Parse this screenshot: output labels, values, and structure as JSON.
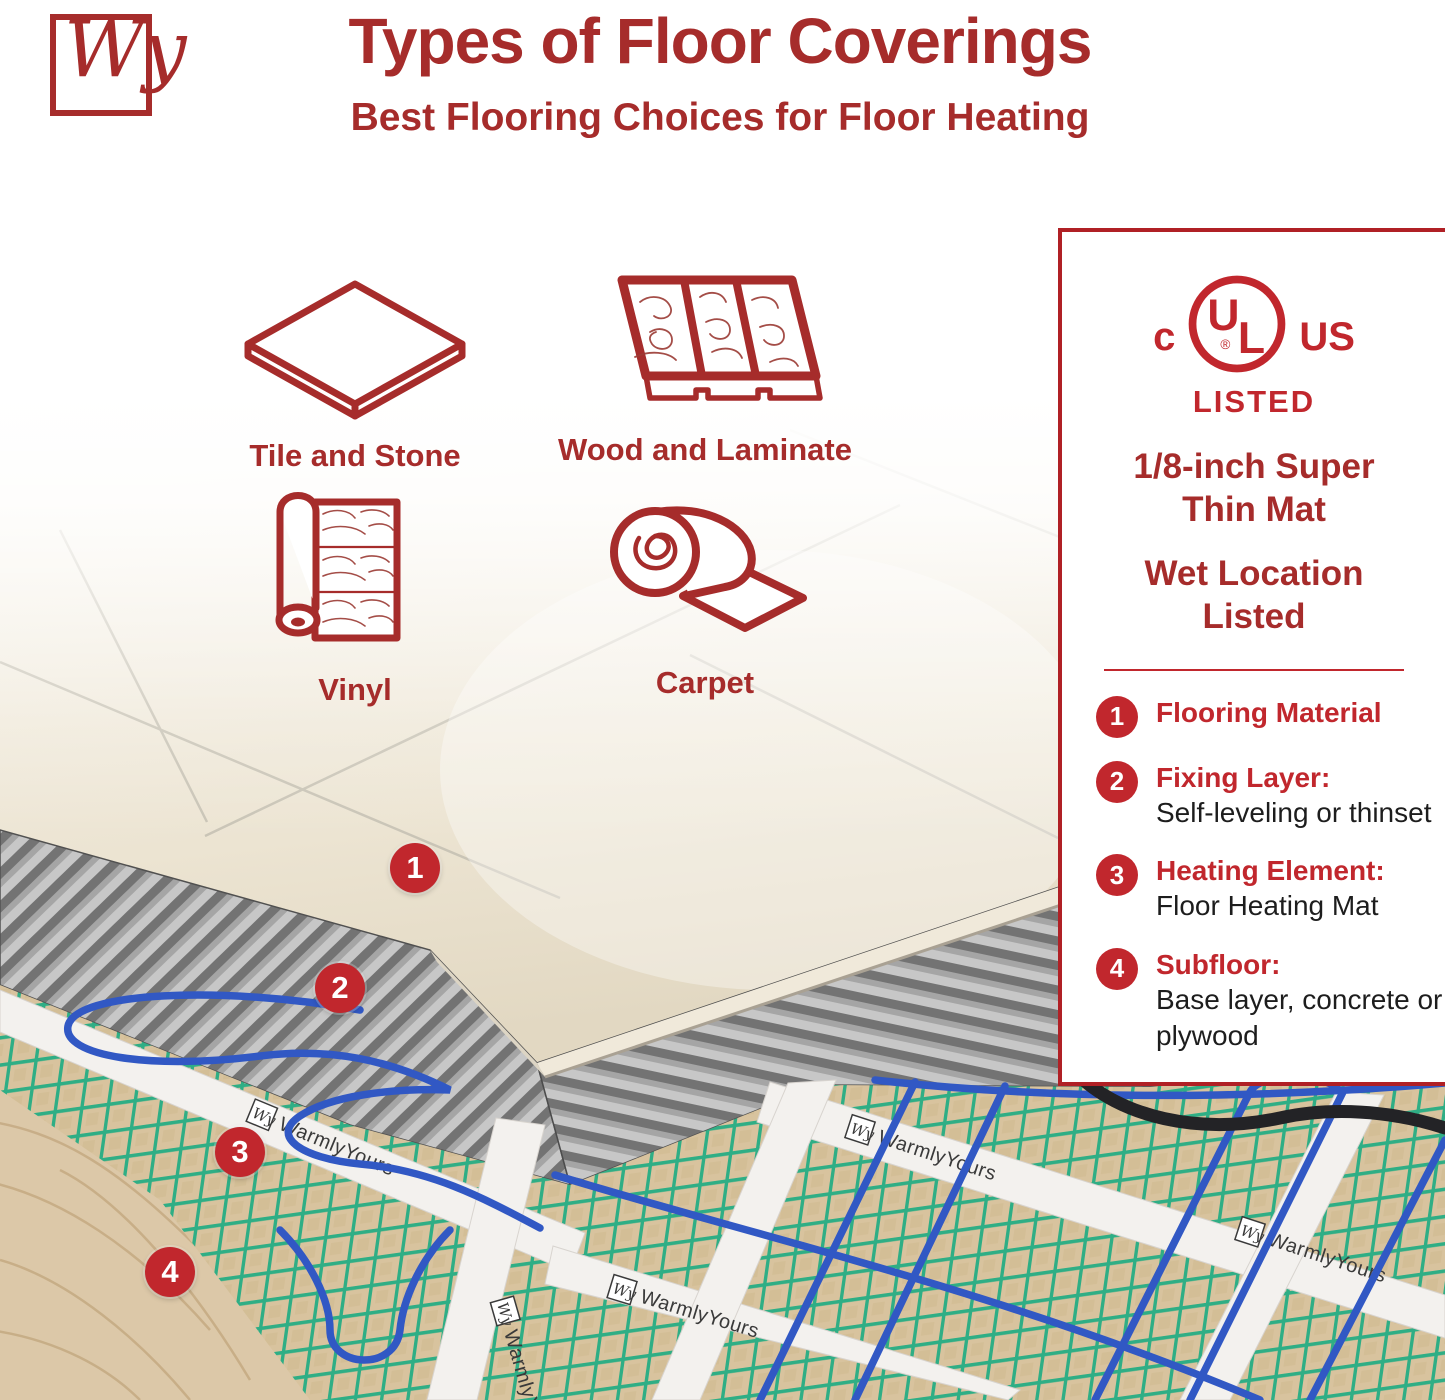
{
  "brand_logo": {
    "text": "Wy"
  },
  "header": {
    "title": "Types of Floor Coverings",
    "subtitle": "Best Flooring Choices for Floor Heating"
  },
  "floor_types": [
    {
      "label": "Tile and Stone"
    },
    {
      "label": "Wood and Laminate"
    },
    {
      "label": "Vinyl"
    },
    {
      "label": "Carpet"
    }
  ],
  "panel": {
    "ul_mark": {
      "prefix": "c",
      "letter_u": "U",
      "letter_l": "L",
      "registered": "®",
      "suffix": "US",
      "listed": "LISTED"
    },
    "features": [
      "1/8-inch Super Thin Mat",
      "Wet Location Listed"
    ],
    "legend": [
      {
        "num": "1",
        "title": "Flooring Material",
        "desc": ""
      },
      {
        "num": "2",
        "title": "Fixing Layer:",
        "desc": "Self-leveling or thinset"
      },
      {
        "num": "3",
        "title": "Heating Element:",
        "desc": "Floor Heating Mat"
      },
      {
        "num": "4",
        "title": "Subfloor:",
        "desc": "Base layer, concrete or plywood"
      }
    ]
  },
  "photo": {
    "brand": "WarmlyYours",
    "callouts": [
      {
        "num": "1"
      },
      {
        "num": "2"
      },
      {
        "num": "3"
      },
      {
        "num": "4"
      }
    ]
  },
  "colors": {
    "brand_red": "#A62C2B",
    "badge_red": "#C1272D",
    "panel_border_red": "#B02025",
    "mesh_green": "#2FAE85",
    "mesh_backing_tan": "#D8C39E",
    "cable_blue": "#3158C4",
    "power_lead_black": "#232326",
    "tile_cream": "#EFE9DB",
    "thinset_gray": "#8A8A8A",
    "wood_tan": "#DCC8A8"
  }
}
